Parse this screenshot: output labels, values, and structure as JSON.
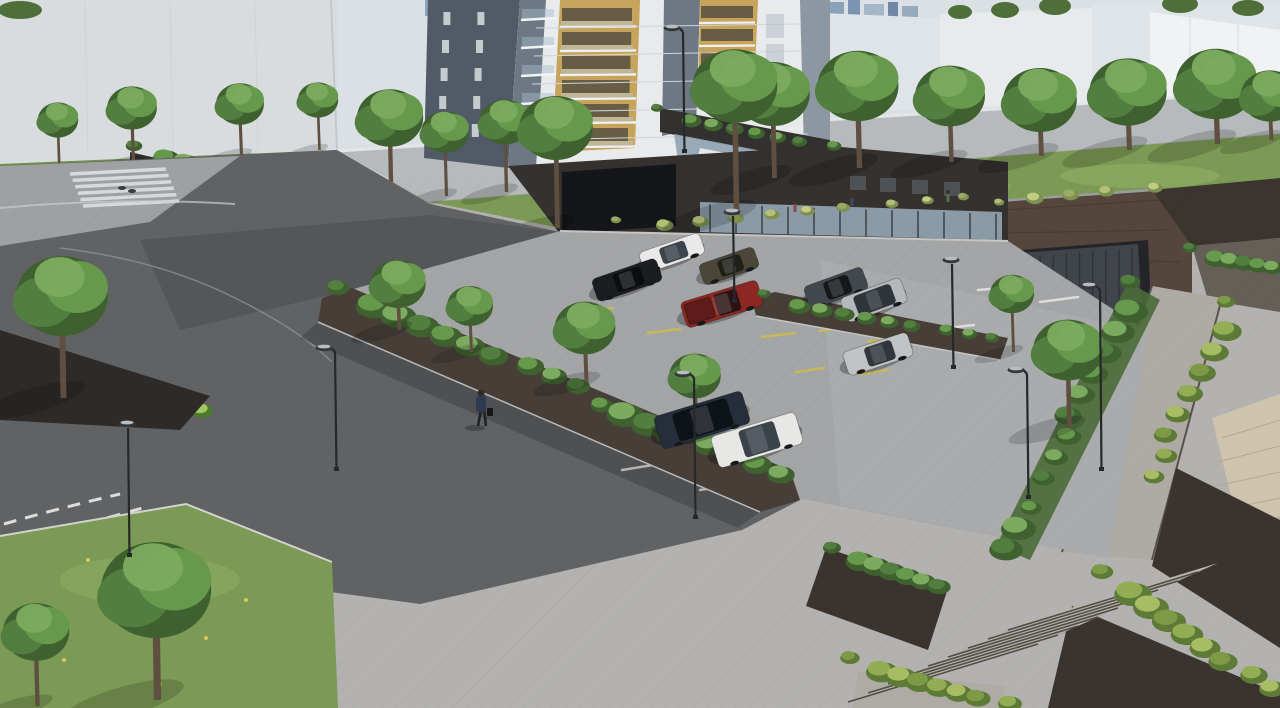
{
  "scene": {
    "title": "Residential complex aerial rendering",
    "description": "Aerial architectural rendering of an apartment tower with brick podium, surface parking lot with nine cars, raised landscaped park behind a brick retaining wall with underground garage door, tree-lined street, paved plaza with a pedestrian, lawns, planters, stairs and street lamps."
  },
  "colors": {
    "bg": "#dbe0e4",
    "wallWhite": "#d8dcdf",
    "bgBldgA": "#eceef0",
    "bgBldgB": "#dfe4e8",
    "bgBldgC": "#e7ebee",
    "bgBldgD": "#f0f2f4",
    "street": "#b7babc",
    "sidewalk": "#e3e6e8",
    "lawn": "#7b9a55",
    "lawnLight": "#93b168",
    "meadowBase": "#9cab66",
    "gravel": "#cdc7b5",
    "brick": "#54453d",
    "brick2": "#473e38",
    "brickDark": "#3a332e",
    "garage": "#40454c",
    "towerWhite": "#e8eaeb",
    "towerGrayDark": "#515a66",
    "towerGray": "#6e7884",
    "towerGrayLight": "#8d97a1",
    "amber": "#c7a45c",
    "podium": "#333130",
    "podium2": "#34312f",
    "undercroft": "#1f2123",
    "glass": "#93a7b5",
    "entry": "#141619",
    "plaza": "#b3b2b0",
    "road": "#606264",
    "roadSun": "#9ea0a2",
    "asphalt": "#a4a5a7",
    "asphaltSun": "#aeafb1",
    "pathPavers": "#aeaba4",
    "stone": "#cec3ad",
    "yellowLine": "#c9b957",
    "whiteLine": "#dcdddc",
    "lampDark": "#26282a",
    "lampLight": "#c9ccce",
    "trunk": "#5f4f41"
  },
  "palettes": {
    "foliage": [
      "#3f6130",
      "#527e3f",
      "#67994d",
      "#7cab5f"
    ],
    "meadow": [
      "#7d904f",
      "#9aab63",
      "#b2bf74",
      "#c3cc82"
    ],
    "fern": [
      "#4c7a2e",
      "#6f9f3f",
      "#8cb94f",
      "#a1c75f"
    ],
    "grass": [
      "#5d7a36",
      "#7d9a47",
      "#93ad55",
      "#a8bd63"
    ]
  },
  "objects": {
    "cars": [
      {
        "name": "white-sedan",
        "type": "sedan",
        "x": 672,
        "y": 253,
        "a": -19,
        "l": 64,
        "w": 22,
        "c": "#e8e9e8",
        "gl": "#3c444c"
      },
      {
        "name": "olive-sedan",
        "type": "sedan",
        "x": 729,
        "y": 266,
        "a": -19,
        "l": 58,
        "w": 22,
        "c": "#4c4639",
        "gl": "#1f2018"
      },
      {
        "name": "black-sedan",
        "type": "sedan",
        "x": 627,
        "y": 280,
        "a": -19,
        "l": 68,
        "w": 24,
        "c": "#1b1d20",
        "gl": "#0c0d0f"
      },
      {
        "name": "dark-gray-sedan",
        "type": "sedan",
        "x": 836,
        "y": 288,
        "a": -20,
        "l": 62,
        "w": 24,
        "c": "#43484e",
        "gl": "#15181b"
      },
      {
        "name": "silver-suv",
        "type": "suv",
        "x": 874,
        "y": 300,
        "a": -20,
        "l": 64,
        "w": 26,
        "c": "#b6b9bb",
        "gl": "#2e343a"
      },
      {
        "name": "red-pickup",
        "type": "pickup",
        "x": 722,
        "y": 304,
        "a": -17,
        "l": 80,
        "w": 27,
        "c": "#8c2824",
        "gl": "#2a1214",
        "bed": "#5e1b19"
      },
      {
        "name": "silver-sedan",
        "type": "sedan",
        "x": 878,
        "y": 354,
        "a": -18,
        "l": 68,
        "w": 25,
        "c": "#c0c2c4",
        "gl": "#30363c"
      },
      {
        "name": "navy-suv",
        "type": "suv",
        "x": 702,
        "y": 420,
        "a": -17,
        "l": 92,
        "w": 34,
        "c": "#252e3a",
        "gl": "#0e1319"
      },
      {
        "name": "white-sedan-front",
        "type": "sedan",
        "x": 757,
        "y": 440,
        "a": -17,
        "l": 88,
        "w": 33,
        "c": "#e7e8e6",
        "gl": "#3a424a"
      }
    ],
    "street_trees": [
      {
        "x": 445,
        "y": 132,
        "r": 26,
        "g": 196
      },
      {
        "x": 505,
        "y": 122,
        "r": 28,
        "g": 192
      },
      {
        "x": 773,
        "y": 94,
        "r": 40,
        "g": 178
      },
      {
        "x": 858,
        "y": 86,
        "r": 44,
        "g": 168
      },
      {
        "x": 950,
        "y": 96,
        "r": 38,
        "g": 162
      },
      {
        "x": 1040,
        "y": 100,
        "r": 40,
        "g": 156
      },
      {
        "x": 1128,
        "y": 92,
        "r": 42,
        "g": 150
      },
      {
        "x": 1216,
        "y": 84,
        "r": 44,
        "g": 144
      },
      {
        "x": 1270,
        "y": 96,
        "r": 32,
        "g": 140
      }
    ],
    "wall_trees": [
      {
        "x": 58,
        "y": 120,
        "r": 22,
        "g": 172
      },
      {
        "x": 132,
        "y": 108,
        "r": 27,
        "g": 164
      },
      {
        "x": 240,
        "y": 104,
        "r": 26,
        "g": 156
      },
      {
        "x": 318,
        "y": 100,
        "r": 22,
        "g": 150
      }
    ],
    "building_trees": [
      {
        "x": 390,
        "y": 118,
        "r": 36,
        "g": 208
      },
      {
        "x": 556,
        "y": 128,
        "r": 40,
        "g": 228
      },
      {
        "x": 735,
        "y": 86,
        "r": 46,
        "g": 215
      }
    ],
    "planter_trees": [
      {
        "x": 398,
        "y": 284,
        "r": 30,
        "g": 330
      },
      {
        "x": 470,
        "y": 306,
        "r": 25,
        "g": 352
      },
      {
        "x": 585,
        "y": 328,
        "r": 33,
        "g": 382
      },
      {
        "x": 695,
        "y": 376,
        "r": 28,
        "g": 420
      }
    ],
    "right_trees": [
      {
        "x": 1012,
        "y": 294,
        "r": 24,
        "g": 352
      },
      {
        "x": 1068,
        "y": 350,
        "r": 38,
        "g": 428
      }
    ],
    "lawn_trees": [
      {
        "x": 156,
        "y": 590,
        "r": 60,
        "g": 700
      },
      {
        "x": 36,
        "y": 632,
        "r": 36,
        "g": 706
      },
      {
        "x": 62,
        "y": 296,
        "r": 50,
        "g": 398
      }
    ],
    "shrub_bands": [
      {
        "from": [
          344,
          292
        ],
        "to": [
          782,
          478
        ],
        "count": 18,
        "r": 15,
        "pal": "foliage"
      },
      {
        "from": [
          1136,
          286
        ],
        "to": [
          1010,
          548
        ],
        "count": 13,
        "r": 14,
        "pal": "foliage"
      },
      {
        "from": [
          140,
          150
        ],
        "to": [
          352,
          200
        ],
        "count": 11,
        "r": 11,
        "pal": "foliage"
      },
      {
        "from": [
          663,
          112
        ],
        "to": [
          828,
          148
        ],
        "count": 8,
        "r": 8,
        "pal": "foliage"
      },
      {
        "from": [
          622,
          224
        ],
        "to": [
          1150,
          188
        ],
        "count": 15,
        "r": 7,
        "pal": "meadow"
      },
      {
        "from": [
          6,
          352
        ],
        "to": [
          198,
          414
        ],
        "count": 9,
        "r": 13,
        "pal": "fern"
      },
      {
        "from": [
          838,
          552
        ],
        "to": [
          944,
          588
        ],
        "count": 7,
        "r": 12,
        "pal": "foliage"
      },
      {
        "from": [
          856,
          662
        ],
        "to": [
          1004,
          706
        ],
        "count": 8,
        "r": 13,
        "pal": "grass"
      },
      {
        "from": [
          1108,
          576
        ],
        "to": [
          1268,
          692
        ],
        "count": 9,
        "r": 15,
        "pal": "grass"
      },
      {
        "from": [
          1232,
          306
        ],
        "to": [
          1150,
          480
        ],
        "count": 9,
        "r": 12,
        "pal": "grass"
      },
      {
        "from": [
          1196,
          252
        ],
        "to": [
          1276,
          268
        ],
        "count": 6,
        "r": 10,
        "pal": "foliage"
      },
      {
        "from": [
          770,
          298
        ],
        "to": [
          990,
          342
        ],
        "count": 10,
        "r": 9,
        "pal": "foliage"
      }
    ],
    "lamps": [
      {
        "x": 128,
        "y1": 424,
        "y2": 556,
        "t": "disc"
      },
      {
        "x": 694,
        "y1": 374,
        "y2": 518,
        "t": "curve"
      },
      {
        "x": 335,
        "y1": 348,
        "y2": 470,
        "t": "curve"
      },
      {
        "x": 1100,
        "y1": 286,
        "y2": 470,
        "t": "curve"
      },
      {
        "x": 1027,
        "y1": 370,
        "y2": 498,
        "t": "curve"
      },
      {
        "x": 733,
        "y1": 212,
        "y2": 302,
        "t": "disc"
      },
      {
        "x": 952,
        "y1": 260,
        "y2": 368,
        "t": "disc"
      },
      {
        "x": 683,
        "y1": 28,
        "y2": 152,
        "t": "curve"
      }
    ],
    "person": {
      "x": 481,
      "y": 390
    },
    "park_people": [
      {
        "x": 795,
        "y": 204,
        "c": "#8a4b42"
      },
      {
        "x": 852,
        "y": 198,
        "c": "#3e4c63"
      },
      {
        "x": 948,
        "y": 194,
        "c": "#5c6d52"
      }
    ],
    "parking_lines": {
      "yellow": [
        [
          580,
          312,
          613,
          308
        ],
        [
          648,
          333,
          680,
          329
        ],
        [
          745,
          304,
          778,
          300
        ],
        [
          762,
          337,
          795,
          333
        ],
        [
          820,
          331,
          851,
          327
        ],
        [
          868,
          342,
          897,
          338
        ],
        [
          796,
          372,
          824,
          368
        ],
        [
          860,
          374,
          888,
          370
        ]
      ],
      "white": [
        [
          978,
          290,
          1022,
          286
        ],
        [
          1040,
          302,
          1078,
          297
        ],
        [
          930,
          330,
          974,
          325
        ],
        [
          622,
          470,
          672,
          462
        ],
        [
          700,
          490,
          748,
          482
        ]
      ]
    },
    "crosswalk": {
      "x": 70,
      "y": 174,
      "count": 6,
      "len": 96,
      "stepX": 2.6,
      "stepY": 6.4
    },
    "stairs": {
      "p0": [
        848,
        702
      ],
      "dir": [
        190,
        -58
      ],
      "n": [
        20,
        -9
      ],
      "count": 9
    },
    "flowers": [
      [
        88,
        560
      ],
      [
        128,
        606
      ],
      [
        206,
        638
      ],
      [
        64,
        660
      ],
      [
        246,
        600
      ],
      [
        160,
        684
      ]
    ],
    "garage_grooves": 10
  }
}
